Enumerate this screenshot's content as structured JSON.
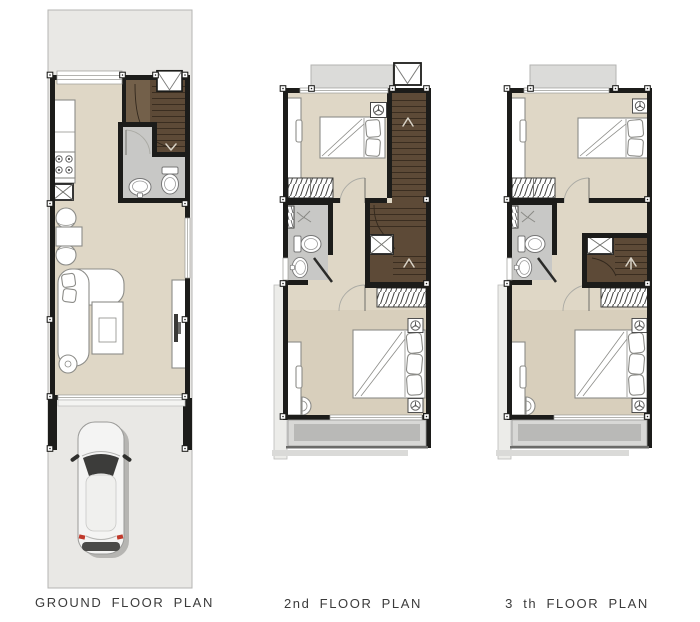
{
  "palette": {
    "page_bg": "#ffffff",
    "wall": "#1c1c1a",
    "lot_gray": "#e9e8e5",
    "lot_border": "#b5b5b3",
    "floor_beige": "#dfd7c6",
    "floor_beige_dark": "#d8cfbc",
    "bath_gray": "#c8c8c6",
    "stair_brown": "#5d4a37",
    "stair_brown_light": "#73604a",
    "canopy_gray": "#dbdbd9",
    "balcony_gray": "#b9b9b7",
    "balcony_frame": "#d8d8d6",
    "furniture_line": "#8c8c88",
    "car_body": "#f4f4f3",
    "car_glass": "#3c3c3a",
    "car_red": "#c0392b",
    "label_text": "#3b3b3b"
  },
  "plans": [
    {
      "id": "ground-floor",
      "label": "GROUND FLOOR PLAN"
    },
    {
      "id": "second-floor",
      "label": "2nd FLOOR PLAN"
    },
    {
      "id": "third-floor",
      "label": "3 th FLOOR PLAN"
    }
  ],
  "icons": {
    "ac_condenser": "envelope-box",
    "ceiling_fan": "circle-fan",
    "stair_up_arrow": "^",
    "stair_down_arrow": "v"
  }
}
